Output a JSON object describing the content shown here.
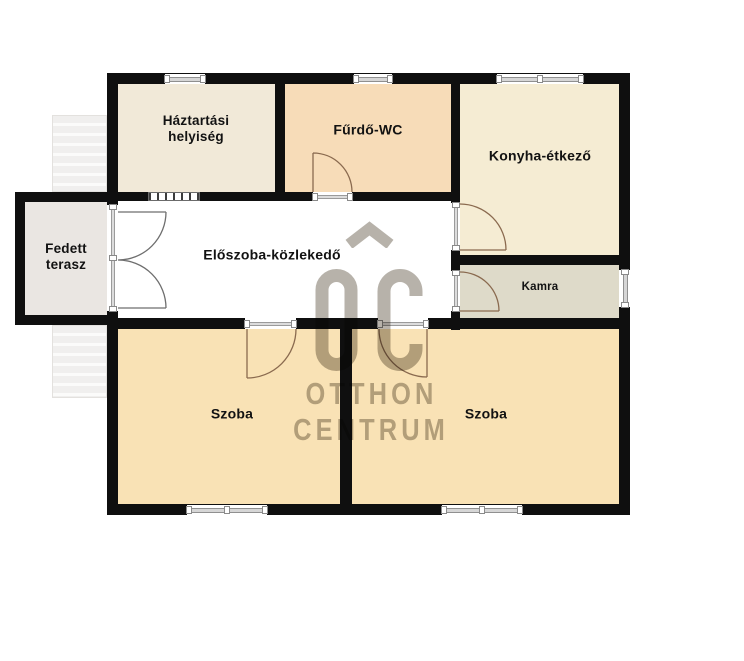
{
  "watermark": {
    "line1": "OTTHON",
    "line2": "CENTRUM",
    "color": "#b7b2aa"
  },
  "floorplan": {
    "background": "#ffffff",
    "wall_color": "#0f0f0f",
    "interior_door_arc_color": "#8a6a4f",
    "terrace_door_arc_color": "#6e6e6e",
    "rooms": [
      {
        "name": "haztartasi-helyiseg",
        "label_lines": [
          "Háztartási",
          "helyiség"
        ],
        "rect": [
          118,
          84,
          157,
          108
        ],
        "fill": "#f1e9d8",
        "label_xy": [
          196,
          129
        ],
        "font": 13.5
      },
      {
        "name": "furdo-wc",
        "label_lines": [
          "Fűrdő-WC"
        ],
        "rect": [
          285,
          84,
          166,
          108
        ],
        "fill": "#f7dcb8",
        "label_xy": [
          368,
          130
        ],
        "font": 14
      },
      {
        "name": "konyha-etkezo",
        "label_lines": [
          "Konyha-étkező"
        ],
        "rect": [
          460,
          84,
          159,
          171
        ],
        "fill": "#f5ecd3",
        "label_xy": [
          540,
          156
        ],
        "font": 14
      },
      {
        "name": "eloszoba-kozlekedo",
        "label_lines": [
          "Előszoba-közlekedő"
        ],
        "rect": [
          118,
          201,
          333,
          117
        ],
        "fill": "#ffffff",
        "label_xy": [
          272,
          255
        ],
        "font": 14
      },
      {
        "name": "kamra",
        "label_lines": [
          "Kamra"
        ],
        "rect": [
          460,
          265,
          159,
          53
        ],
        "fill": "#dedac9",
        "label_xy": [
          540,
          288
        ],
        "font": 11.5
      },
      {
        "name": "szoba-bal",
        "label_lines": [
          "Szoba"
        ],
        "rect": [
          118,
          329,
          222,
          175
        ],
        "fill": "#f9e2b5",
        "label_xy": [
          232,
          414
        ],
        "font": 14
      },
      {
        "name": "szoba-jobb",
        "label_lines": [
          "Szoba"
        ],
        "rect": [
          352,
          329,
          267,
          175
        ],
        "fill": "#f9e2b5",
        "label_xy": [
          486,
          414
        ],
        "font": 14
      },
      {
        "name": "fedett-terasz",
        "label_lines": [
          "Fedett",
          "terasz"
        ],
        "rect": [
          25,
          202,
          82,
          113
        ],
        "fill": "#eae6e2",
        "label_xy": [
          66,
          257
        ],
        "font": 13.5
      }
    ],
    "stairs": [
      {
        "name": "stairs-upper",
        "rect": [
          52,
          115,
          55,
          77
        ]
      },
      {
        "name": "stairs-lower",
        "rect": [
          52,
          325,
          55,
          73
        ]
      }
    ],
    "walls": [
      [
        107,
        73,
        523,
        11
      ],
      [
        107,
        504,
        523,
        11
      ],
      [
        107,
        73,
        11,
        132
      ],
      [
        107,
        311,
        11,
        204
      ],
      [
        619,
        73,
        11,
        197
      ],
      [
        619,
        307,
        11,
        208
      ],
      [
        107,
        192,
        41,
        9
      ],
      [
        200,
        192,
        113,
        9
      ],
      [
        352,
        192,
        108,
        9
      ],
      [
        275,
        84,
        10,
        108
      ],
      [
        451,
        84,
        9,
        119
      ],
      [
        451,
        250,
        9,
        21
      ],
      [
        451,
        311,
        9,
        19
      ],
      [
        460,
        255,
        159,
        10
      ],
      [
        107,
        318,
        138,
        11
      ],
      [
        296,
        318,
        82,
        11
      ],
      [
        428,
        318,
        202,
        11
      ],
      [
        340,
        329,
        12,
        175
      ],
      [
        15,
        192,
        10,
        133
      ],
      [
        15,
        192,
        92,
        10
      ],
      [
        15,
        315,
        92,
        10
      ]
    ],
    "windows": [
      {
        "name": "window-haztartasi",
        "rect": [
          165,
          74,
          40,
          10
        ],
        "caps": [
          0,
          1
        ],
        "hatched": false
      },
      {
        "name": "window-furdo",
        "rect": [
          354,
          74,
          38,
          10
        ],
        "caps": [
          0,
          1
        ],
        "hatched": false
      },
      {
        "name": "window-konyha",
        "rect": [
          497,
          74,
          86,
          10
        ],
        "caps": [
          0,
          0.5,
          1
        ],
        "hatched": false
      },
      {
        "name": "window-szoba-bal",
        "rect": [
          187,
          505,
          80,
          10
        ],
        "caps": [
          0,
          0.5,
          1
        ],
        "hatched": false
      },
      {
        "name": "window-szoba-jobb",
        "rect": [
          442,
          505,
          80,
          10
        ],
        "caps": [
          0,
          0.5,
          1
        ],
        "hatched": false
      },
      {
        "name": "window-kamra",
        "rect": [
          620,
          270,
          10,
          37
        ],
        "caps": [
          0,
          1
        ],
        "hatched": false
      },
      {
        "name": "partition-window-haztartasi",
        "rect": [
          148,
          192,
          52,
          9
        ],
        "caps": [],
        "hatched": true
      }
    ],
    "door_openings": [
      {
        "name": "terasz-door-opening",
        "rect": [
          107,
          205,
          11,
          106
        ],
        "caps": [
          0,
          0.5,
          1
        ]
      },
      {
        "name": "furdo-door-opening",
        "rect": [
          313,
          192,
          39,
          9
        ],
        "caps": [
          0,
          1
        ]
      },
      {
        "name": "konyha-door-opening",
        "rect": [
          451,
          203,
          9,
          47
        ],
        "caps": [
          0,
          1
        ]
      },
      {
        "name": "kamra-door-opening",
        "rect": [
          451,
          271,
          9,
          40
        ],
        "caps": [
          0,
          1
        ]
      },
      {
        "name": "szoba-bal-door-opening",
        "rect": [
          245,
          318,
          51,
          11
        ],
        "caps": [
          0,
          1
        ]
      },
      {
        "name": "szoba-jobb-door-opening",
        "rect": [
          378,
          318,
          50,
          11
        ],
        "caps": [
          0,
          1
        ]
      }
    ],
    "door_arcs": [
      {
        "name": "furdo-door-swing",
        "path": "M313 153 L313 192 M313 153 A39 39 0 0 1 352 192",
        "color": "#8a6a4f"
      },
      {
        "name": "konyha-door-swing",
        "path": "M460 250 L506 250 M460 204 A46 46 0 0 1 506 250",
        "color": "#8a6a4f"
      },
      {
        "name": "kamra-door-swing",
        "path": "M460 311 L499 311 M460 272 A39 39 0 0 1 499 311",
        "color": "#8a6a4f"
      },
      {
        "name": "szoba-bal-door-swing",
        "path": "M247 329 L247 378 M296 329 A49 49 0 0 1 247 378",
        "color": "#8a6a4f"
      },
      {
        "name": "szoba-jobb-door-swing",
        "path": "M427 329 L427 377 M379 329 A48 48 0 0 0 427 377",
        "color": "#8a6a4f"
      },
      {
        "name": "terasz-double-door-swing",
        "path": "M118 212 L166 212 M166 212 A48 48 0 0 1 118 260 M118 308 L166 308 M166 308 A48 48 0 0 0 118 260",
        "color": "#6e6e6e"
      }
    ]
  }
}
